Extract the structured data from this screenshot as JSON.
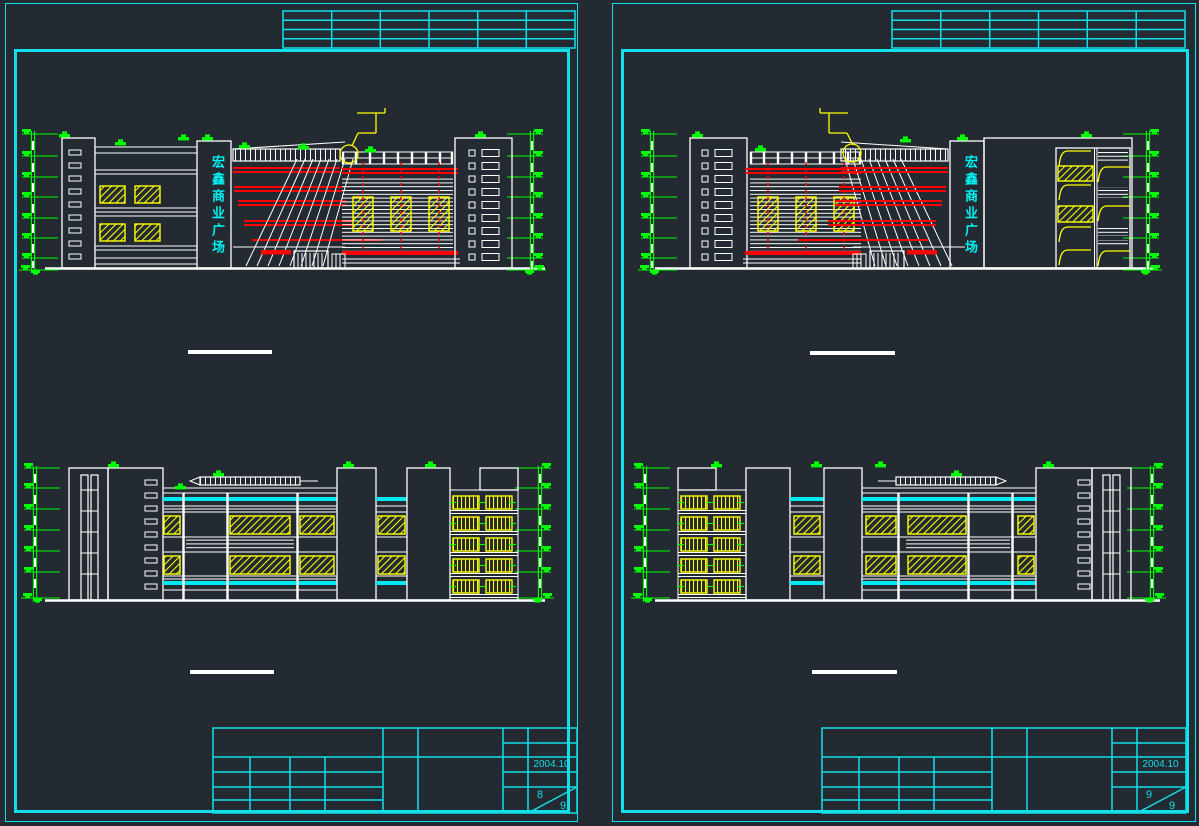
{
  "page": {
    "background": "#232a32"
  },
  "palette": {
    "frame_cyan": "#12dfe9",
    "line_white": "#ffffff",
    "band_red": "#ff0000",
    "detail_yellow": "#ffff00",
    "marker_green": "#00ff00",
    "sign_cyan": "#00f2f2",
    "band_cyan": "#00e8f2"
  },
  "sheets": {
    "left": {
      "sign_text": "宏鑫商业广场",
      "title_block": {
        "date": "2004.10",
        "sheet_number": "8",
        "sheet_total": "9"
      },
      "top_table": {
        "rows": 4,
        "cols": 6
      }
    },
    "right": {
      "sign_text": "宏鑫商业广场",
      "title_block": {
        "date": "2004.10",
        "sheet_number": "9",
        "sheet_total": "9"
      },
      "top_table": {
        "rows": 4,
        "cols": 6
      }
    }
  }
}
